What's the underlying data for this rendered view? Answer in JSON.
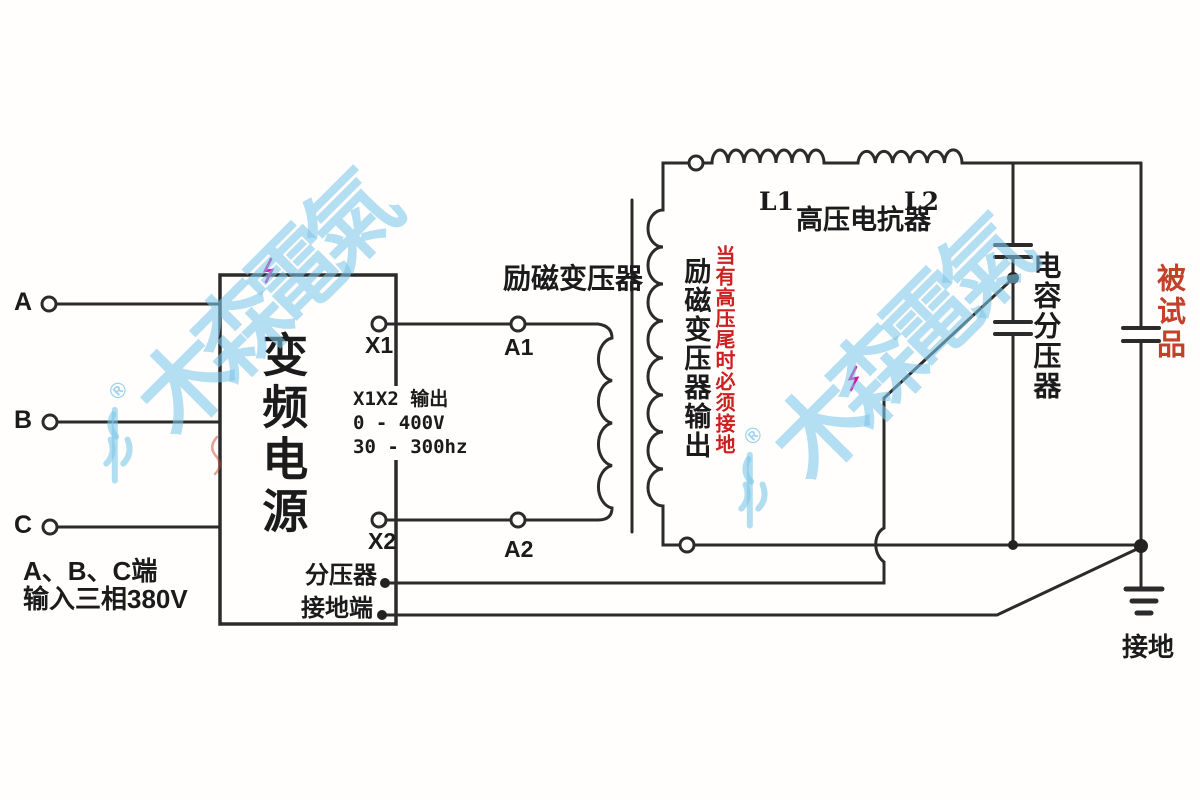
{
  "watermark": {
    "text": "木森電氣",
    "registered": "®",
    "color": "#7dc6e8"
  },
  "inputs": {
    "terminal_a": "A",
    "terminal_b": "B",
    "terminal_c": "C",
    "note_line1": "A、B、C端",
    "note_line2": "输入三相380V"
  },
  "vfc": {
    "name": "变频电源",
    "terminal_x1": "X1",
    "terminal_x2": "X2",
    "divider_terminal": "分压器",
    "ground_terminal": "接地端",
    "output_spec": [
      "X1X2 输出",
      "0 - 400V",
      "30 - 300hz"
    ]
  },
  "excitation_transformer": {
    "name": "励磁变压器",
    "terminal_a1": "A1",
    "terminal_a2": "A2",
    "output_label": "励磁变压器输出",
    "grounding_warning": {
      "text": "当有高压尾时必须接地",
      "color": "#cc2020"
    }
  },
  "reactor": {
    "name": "高压电抗器",
    "coil_l1": "L1",
    "coil_l2": "L2"
  },
  "capacitive_divider": {
    "name": "电容分压器"
  },
  "test_object": {
    "name": "被试品",
    "color": "#c4402a"
  },
  "grounding": {
    "name": "接地"
  },
  "colors": {
    "wire": "#2b2b2b",
    "cursor_mark": "#d016a8"
  }
}
